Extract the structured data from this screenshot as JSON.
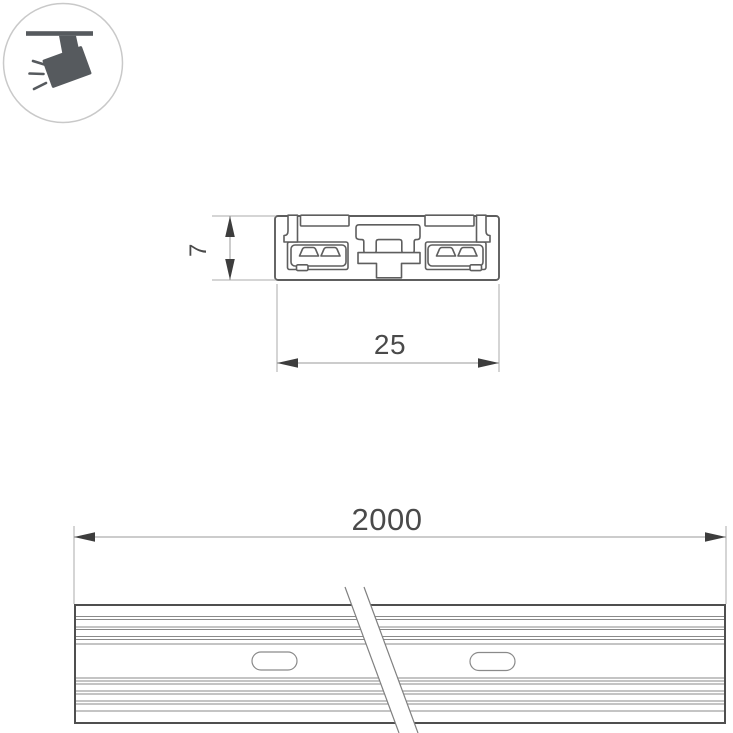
{
  "drawing": {
    "title": "track profile technical drawing",
    "icon": {
      "name": "track-light-icon"
    },
    "cross_section": {
      "height": "7",
      "width": "25"
    },
    "length_view": {
      "length": "2000"
    }
  },
  "colors": {
    "background": "#ffffff",
    "outline": "#5e5e5e",
    "profile_border": "#4f4f4f",
    "groove_line": "#8a8a8a",
    "extension_line": "#ababab",
    "dimension_line": "#9a9a9a",
    "break_line": "#808080",
    "arrow": "#3d3d3d",
    "text": "#4a4a4a",
    "icon_glyph": "#565a5e",
    "icon_circle": "#c9c9c9"
  }
}
